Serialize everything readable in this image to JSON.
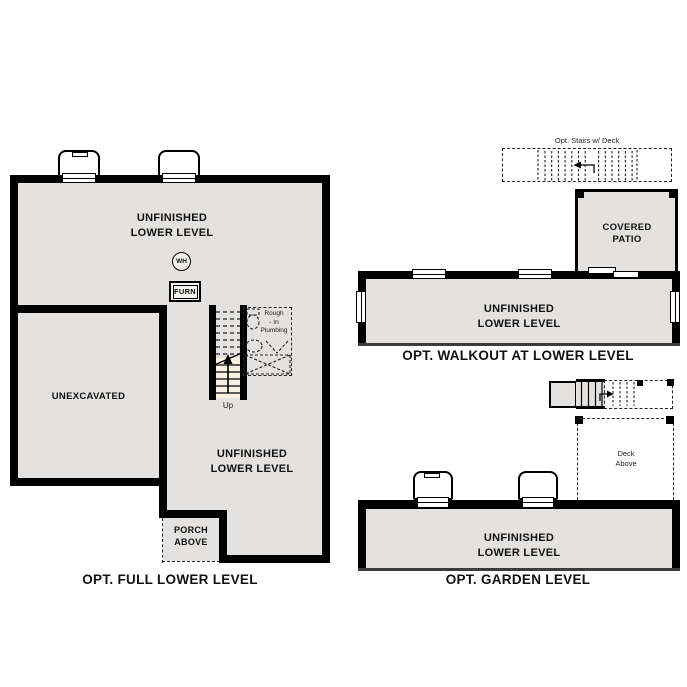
{
  "colors": {
    "floor_fill": "#e4e2e0",
    "stair_fill": "#f7f1e3",
    "wall": "#000000",
    "background": "#ffffff"
  },
  "plans": {
    "full_lower": {
      "caption": "OPT. FULL LOWER LEVEL",
      "room_upper": "UNFINISHED\nLOWER LEVEL",
      "room_lower": "UNFINISHED\nLOWER LEVEL",
      "unexcavated": "UNEXCAVATED",
      "porch": "PORCH\nABOVE",
      "water_heater": "WH",
      "furnace": "FURN",
      "up": "Up",
      "rough_in": "Rough\n- In\nPlumbing"
    },
    "walkout": {
      "caption": "OPT. WALKOUT AT LOWER LEVEL",
      "room": "UNFINISHED\nLOWER LEVEL",
      "patio": "COVERED\nPATIO",
      "stairs_note": "Opt. Stairs w/ Deck"
    },
    "garden": {
      "caption": "OPT. GARDEN LEVEL",
      "room": "UNFINISHED\nLOWER LEVEL",
      "deck": "Deck\nAbove"
    }
  }
}
